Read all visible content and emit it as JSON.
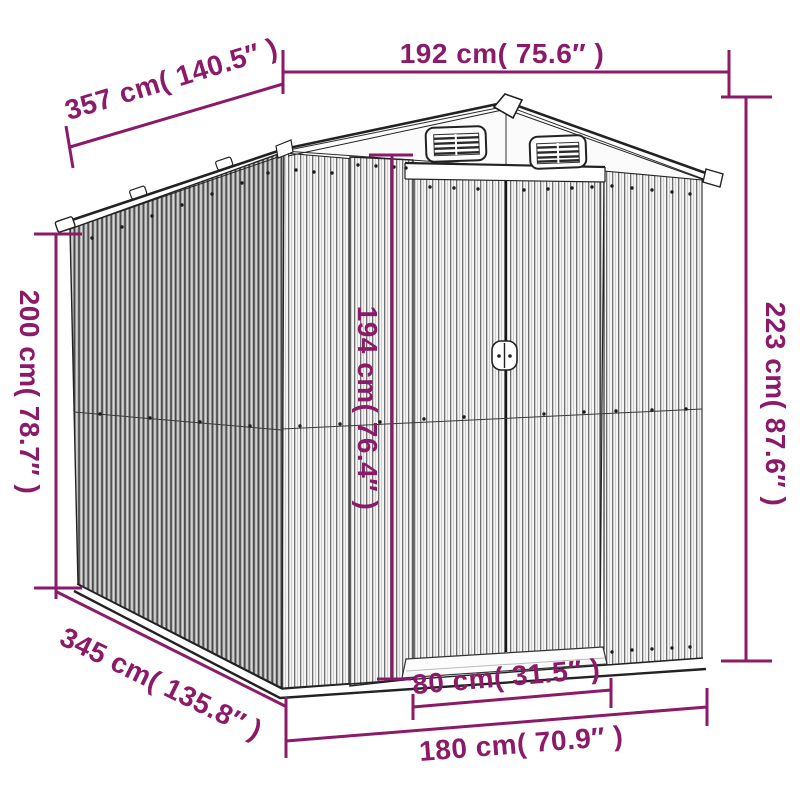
{
  "figure": {
    "type": "product-dimension-diagram",
    "subject": "corrugated metal garden shed line drawing with sliding doors and gable roof vents",
    "accent_color": "#8b1a68"
  },
  "dimensions": {
    "front_width": "192 cm( 75.6″ )",
    "roof_depth": "357 cm( 140.5″ )",
    "wall_height": "200 cm( 78.7″ )",
    "total_height": "223 cm( 87.6″ )",
    "door_height": "194 cm( 76.4″ )",
    "base_depth": "345 cm( 135.8″ )",
    "door_width": "80 cm( 31.5″ )",
    "base_width": "180 cm( 70.9″ )"
  }
}
